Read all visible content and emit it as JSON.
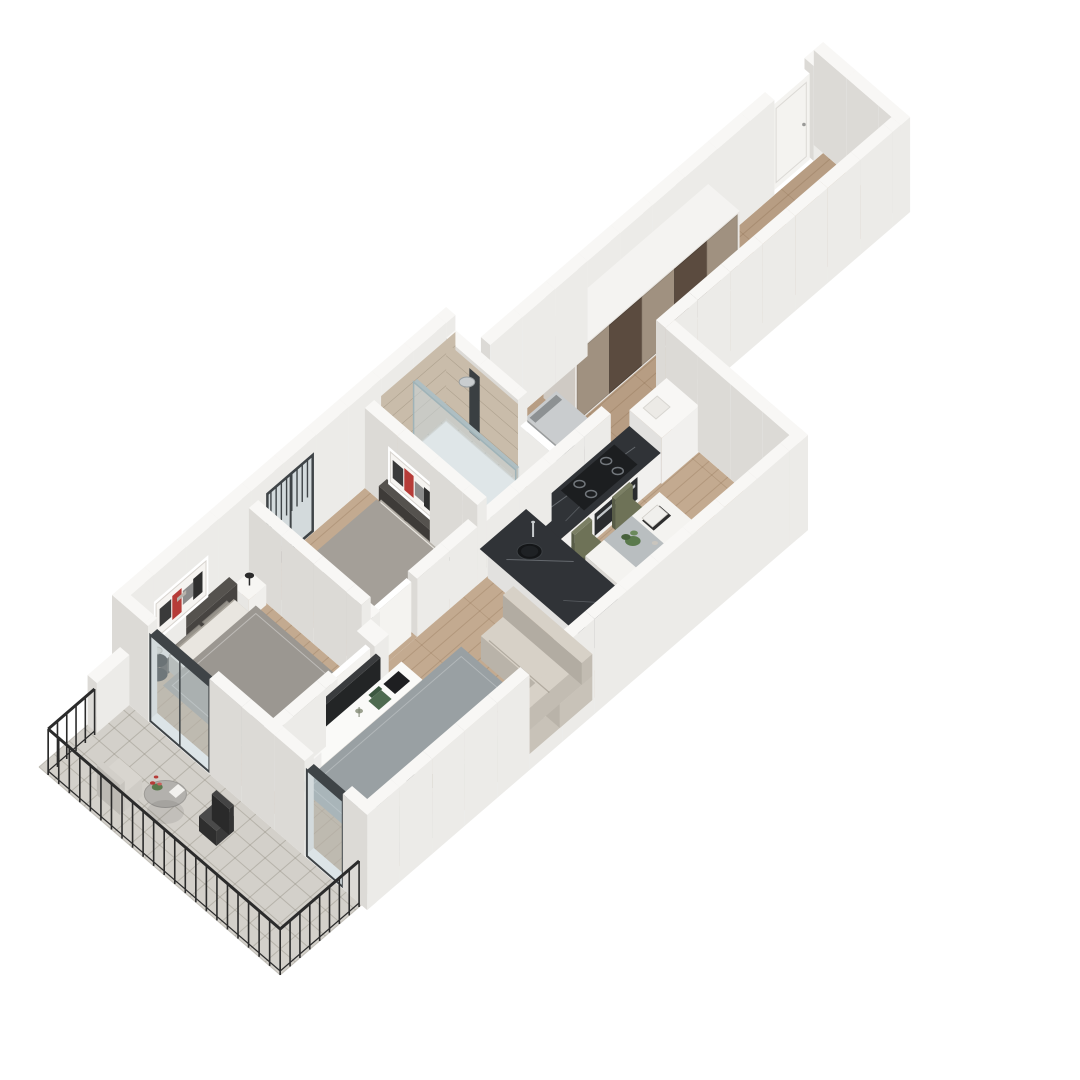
{
  "scene": {
    "kind": "3d-isometric-floor-plan-render",
    "view": "axonometric, apartment oriented diagonally from lower-left balcony to upper-right entry hallway",
    "background": "#ffffff"
  },
  "palette": {
    "bg": "#ffffff",
    "wallTop": "#f8f7f5",
    "wallS": "#ecebe8",
    "wallW": "#dcdad6",
    "doorWhite": "#f4f3f0",
    "wood": "#c3aa90",
    "woodHall": "#b79d83",
    "woodLine": "rgba(120,86,56,0.22)",
    "tile": "#d3d0ca",
    "tileLine": "rgba(140,134,122,0.4)",
    "bathTileFloor": "#cfc6b6",
    "bathTileWall": "#c9bcaa",
    "rugMaster": "#9b9791",
    "rugSecond": "#a49f98",
    "rugLiving": "#99a0a3",
    "duvet": "#aca79e",
    "duvetB": "#b4afa7",
    "sheet": "#e9e6e0",
    "throwDark": "#3e3d3b",
    "headboard": "#474441",
    "pillowDark": "#75716b",
    "pillowLight": "#96928a",
    "sofa": "#c8c2b8",
    "sofaTop": "#d7d1c7",
    "pillowBrown": "#7c5c48",
    "pillowBeige": "#dad2c4",
    "counterDark": "#303337",
    "counterVein": "#9aa0a6",
    "cabinet": "#f1f0ee",
    "cabinetSide": "#e2e1df",
    "hob": "#1c1e20",
    "burnerRing": "#71767b",
    "olive": "#6e7257",
    "oliveDark": "#585c47",
    "tableTop": "#f4f3f0",
    "marbleBand": "#9aa2a6",
    "glass": "rgba(186,202,208,0.5)",
    "frame": "#3f4447",
    "railing": "#2b2b2b",
    "wardrobeDark": "#5b4b3f",
    "wardrobeLight": "#a09180",
    "washer": "#a7abad",
    "washerTop": "#c9ccce",
    "washerDoor": "#33373a",
    "fixtureWhite": "#fbfbf9",
    "chrome": "#c9cdcf",
    "tv": "#232526",
    "black": "#161616",
    "plant": "#5b7a4d",
    "plantDark": "#47613c",
    "red": "#b63c38",
    "lampShade": "#d9d6d0",
    "artBg": "#f6f4f1"
  },
  "rooms": [
    {
      "name": "balcony",
      "floor": "grey-tile",
      "furniture": [
        "black-metal-railing",
        "round-outdoor-table",
        "flower-vase",
        "outdoor-armchair",
        "wire-chair"
      ]
    },
    {
      "name": "master-bedroom",
      "floor": "wood-with-grey-rug",
      "furniture": [
        "double-bed",
        "dark-headboard",
        "pillows",
        "dark-throw",
        "nightstand",
        "table-lamp",
        "abstract-wall-art",
        "tv-media-console",
        "tv",
        "laptop",
        "green-books",
        "sliding-glass-balcony-door"
      ]
    },
    {
      "name": "bedroom-2",
      "floor": "wood-with-grey-rug",
      "furniture": [
        "double-bed",
        "dark-headboard",
        "pillows",
        "dark-throw",
        "black-drum-side-table",
        "table-lamp",
        "abstract-wall-art",
        "glazed-door-with-slats",
        "white-interior-door"
      ]
    },
    {
      "name": "bathroom",
      "floor": "beige-tile",
      "furniture": [
        "walk-in-shower-glass-panel",
        "shower-column",
        "wall-hung-toilet",
        "washbasin-cabinet",
        "interior-door"
      ]
    },
    {
      "name": "kitchen",
      "floor": "wood",
      "furniture": [
        "dark-marble-l-counter",
        "induction-hob",
        "oven",
        "round-black-sink",
        "faucet",
        "tall-white-cabinet"
      ]
    },
    {
      "name": "dining-area",
      "floor": "wood",
      "furniture": [
        "white-marble-dining-table",
        "four-olive-chairs",
        "plant-centerpiece",
        "magazines"
      ]
    },
    {
      "name": "living-room",
      "floor": "wood-with-slate-rug",
      "furniture": [
        "l-shaped-sofa",
        "brown-and-beige-pillows",
        "round-dark-coffee-table",
        "plant-on-table",
        "white-round-side-table",
        "palm-plant",
        "sliding-glass-balcony-door"
      ]
    },
    {
      "name": "entry-hallway",
      "floor": "wood",
      "furniture": [
        "sliding-door-wardrobe-brown-taupe",
        "washing-machine",
        "entry-door"
      ]
    }
  ]
}
